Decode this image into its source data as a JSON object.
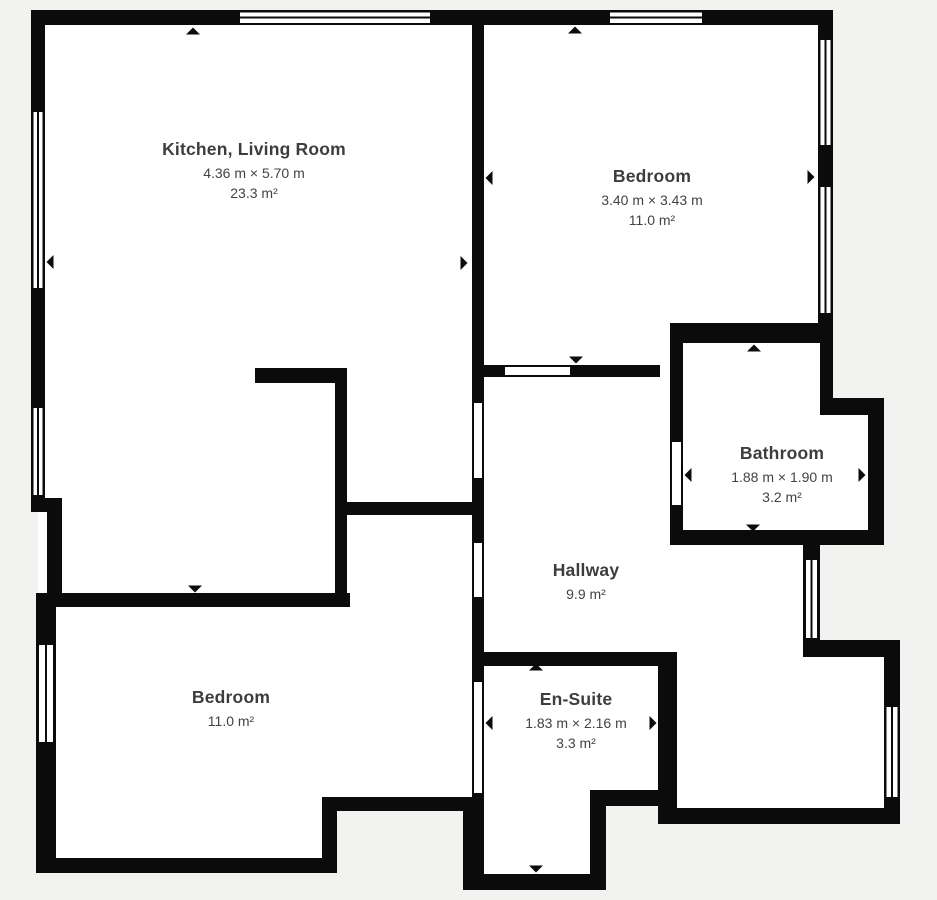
{
  "colors": {
    "background": "#f2f2f1",
    "wall": "#0b0b0b",
    "floor": "#ffffff",
    "text": "#3d3d3d"
  },
  "rooms": {
    "kitchen_living": {
      "name": "Kitchen, Living Room",
      "dimensions": "4.36 m × 5.70 m",
      "area": "23.3 m²"
    },
    "bedroom_top": {
      "name": "Bedroom",
      "dimensions": "3.40 m × 3.43 m",
      "area": "11.0 m²"
    },
    "bathroom": {
      "name": "Bathroom",
      "dimensions": "1.88 m × 1.90 m",
      "area": "3.2 m²"
    },
    "hallway": {
      "name": "Hallway",
      "area": "9.9 m²"
    },
    "bedroom_bottom": {
      "name": "Bedroom",
      "area": "11.0 m²"
    },
    "ensuite": {
      "name": "En-Suite",
      "dimensions": "1.83 m × 2.16 m",
      "area": "3.3 m²"
    }
  }
}
